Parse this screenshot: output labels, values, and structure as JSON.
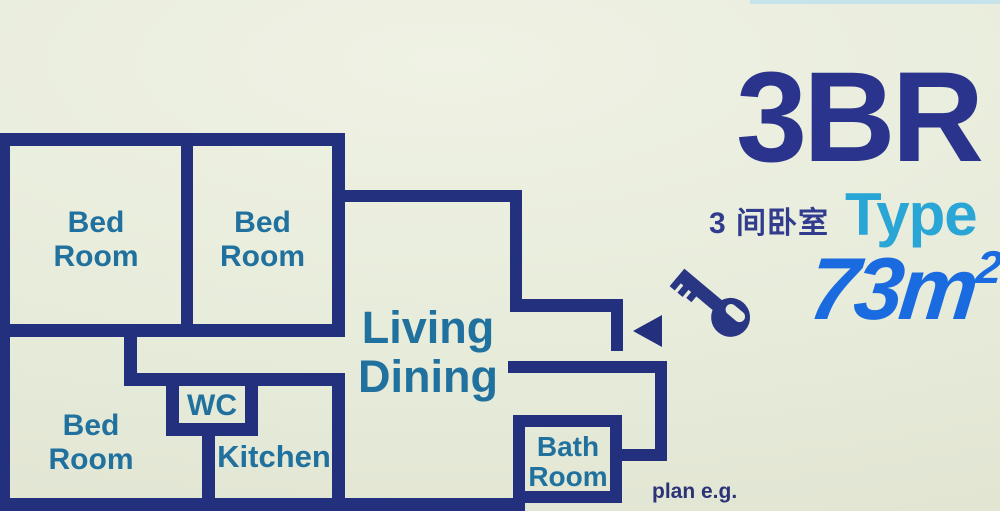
{
  "title_panel": {
    "heading": "3BR",
    "subtitle_cn": "3 间卧室",
    "subtitle_type": "Type",
    "area_value": "73m",
    "area_superscript": "2",
    "footnote": "plan e.g."
  },
  "floorplan": {
    "rooms": [
      {
        "id": "bedroom-1",
        "lines": [
          "Bed",
          "Room"
        ]
      },
      {
        "id": "bedroom-2",
        "lines": [
          "Bed",
          "Room"
        ]
      },
      {
        "id": "bedroom-3",
        "lines": [
          "Bed",
          "Room"
        ]
      },
      {
        "id": "wc",
        "lines": [
          "WC"
        ]
      },
      {
        "id": "kitchen",
        "lines": [
          "Kitchen"
        ]
      },
      {
        "id": "living-dining",
        "lines": [
          "Living",
          "Dining"
        ]
      },
      {
        "id": "bathroom",
        "lines": [
          "Bath",
          "Room"
        ]
      }
    ],
    "icons": [
      "key-icon",
      "entrance-arrow-icon"
    ]
  },
  "colors": {
    "background": "#e8ecdb",
    "wall_navy": "#22307e",
    "room_label_teal": "#21719f",
    "heading_navy": "#2b348c",
    "type_cyan": "#29a5d6",
    "area_blue": "#1a6be0",
    "footnote_navy": "#2b3376"
  }
}
